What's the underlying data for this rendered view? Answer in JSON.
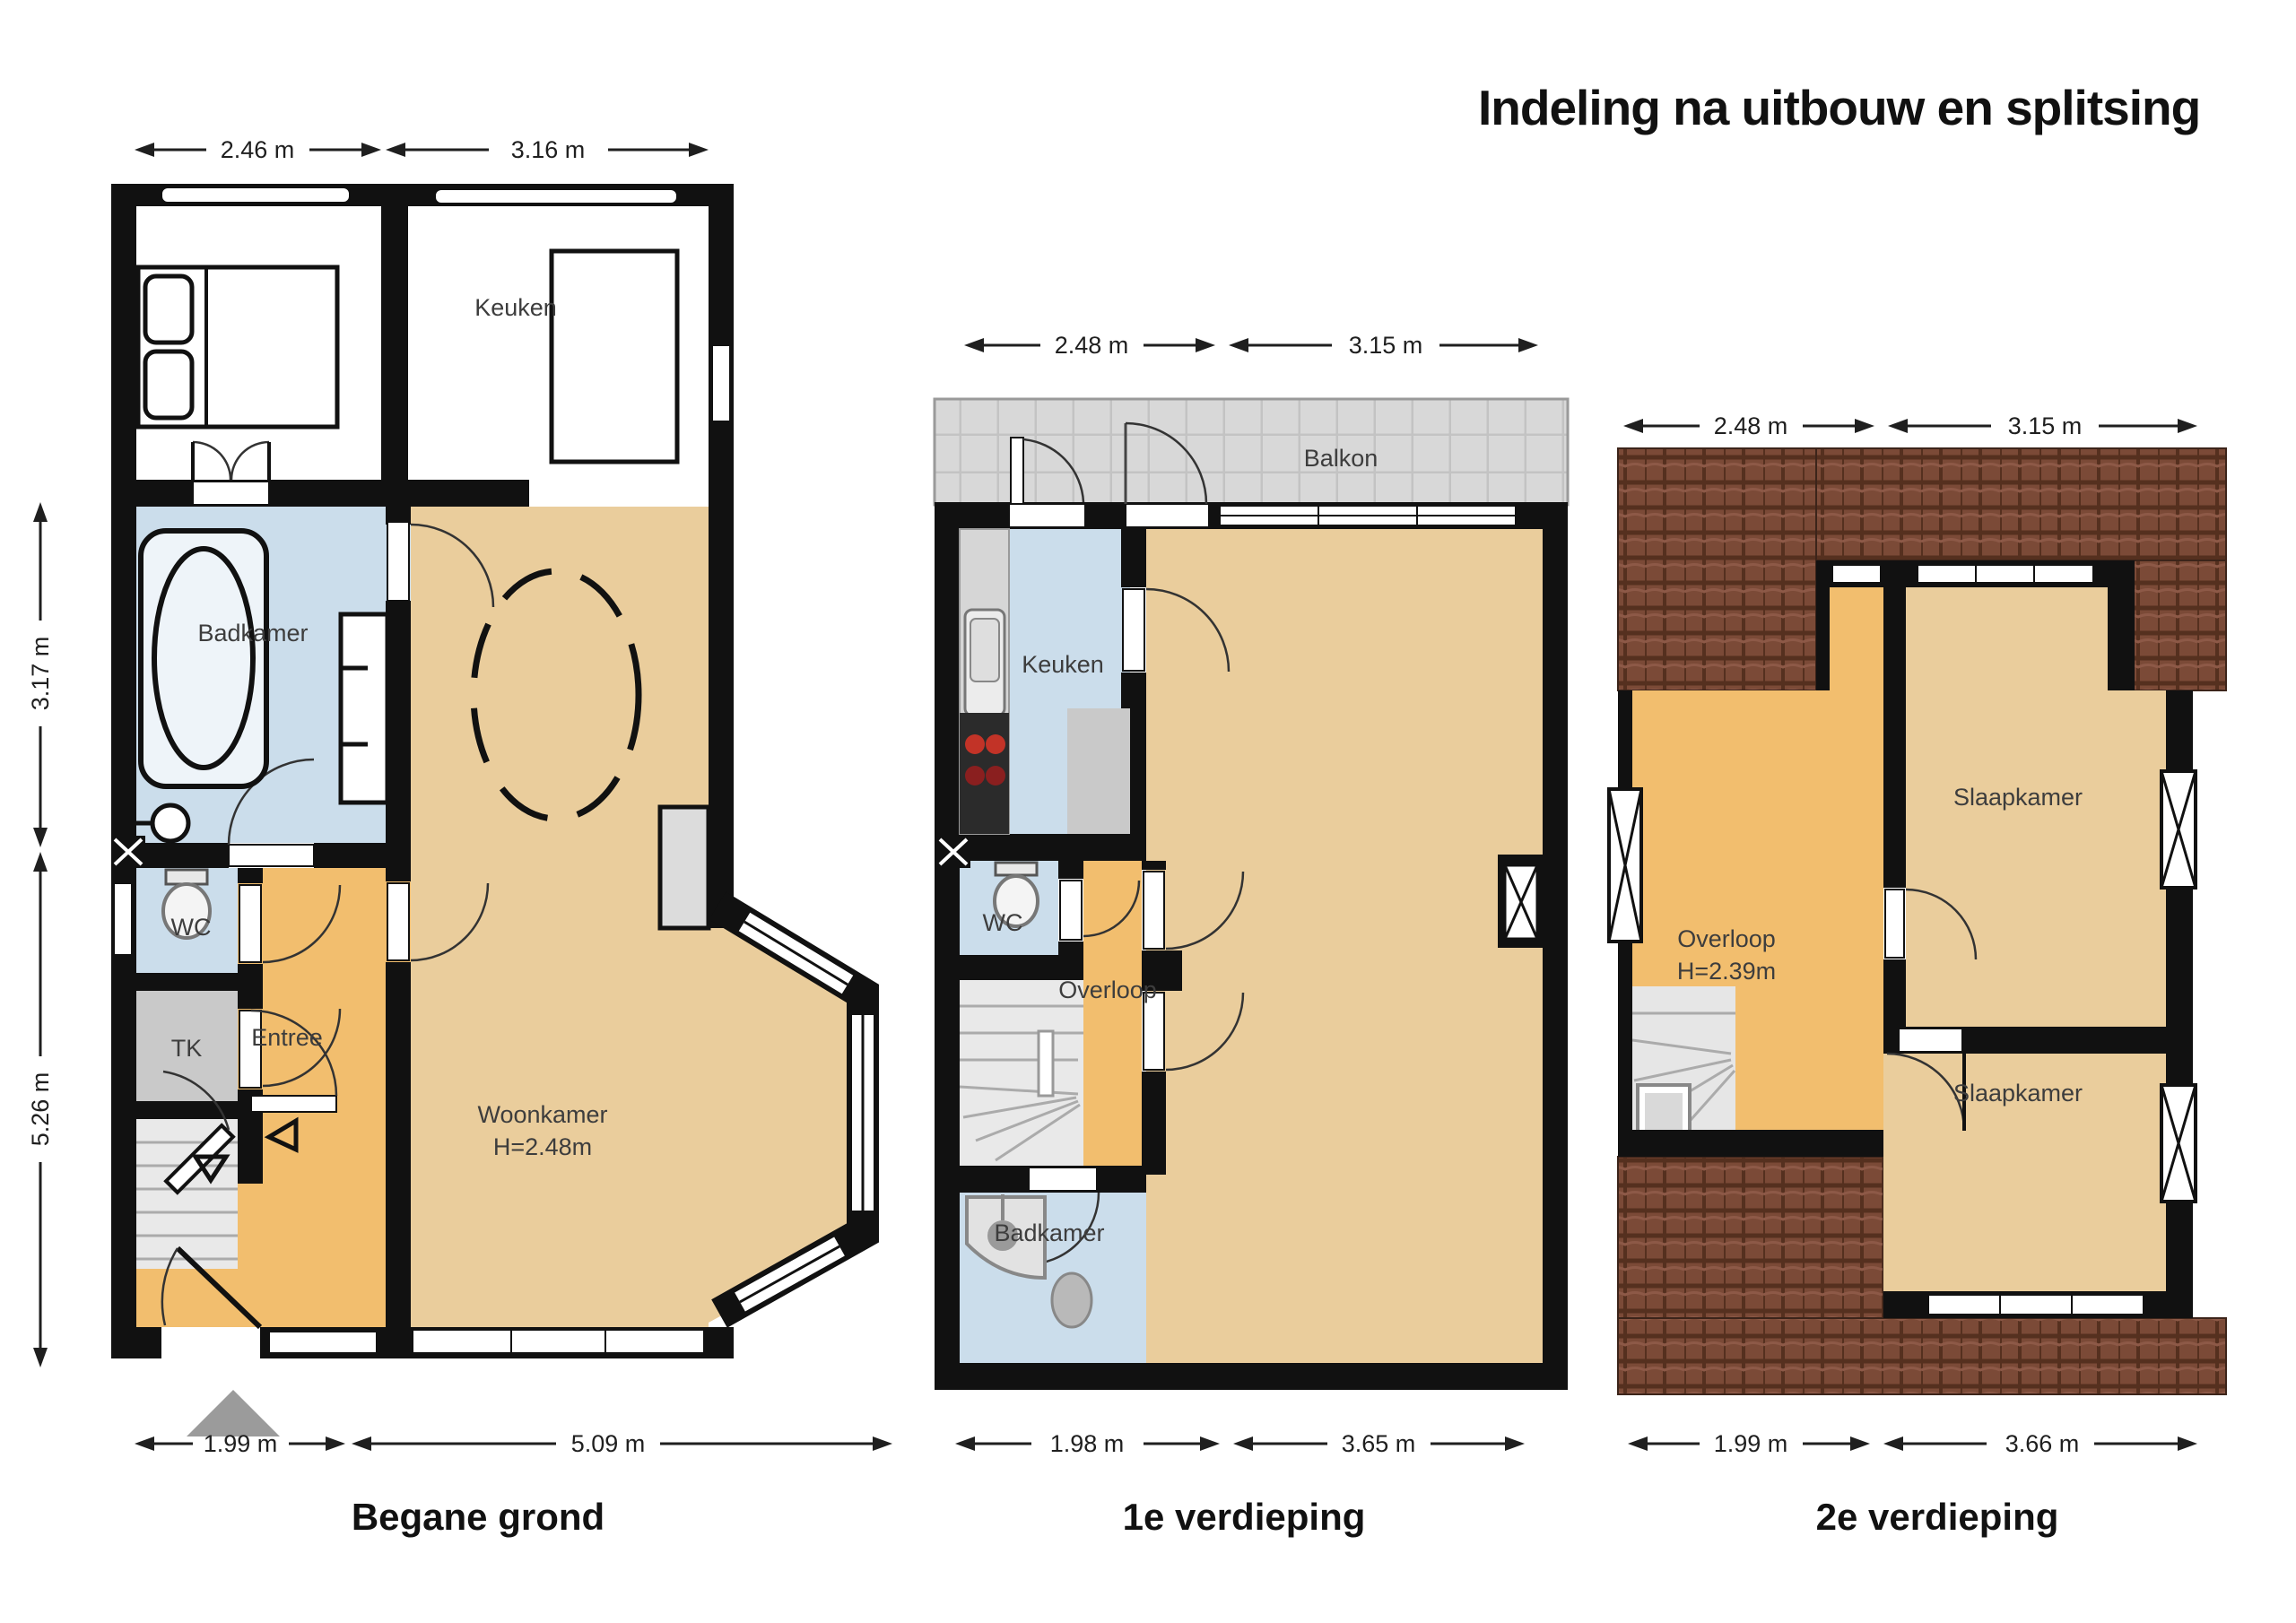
{
  "title": "Indeling na uitbouw en splitsing",
  "colors": {
    "wall": "#111111",
    "floor_tan": "#eacd9c",
    "floor_orange": "#f2be6e",
    "floor_blue": "#cbddeb",
    "floor_gray": "#c9c9c9",
    "stairs_gray": "#e9e9e9",
    "balkon_gray": "#d8d8d8",
    "roof_brown": "#7b4a37",
    "burner_red": "#c23327",
    "entry_arrow_gray": "#9b9b9b"
  },
  "floors": [
    {
      "name": "Begane grond",
      "dims": {
        "top": [
          "2.46 m",
          "3.16 m"
        ],
        "left": [
          "3.17 m",
          "5.26 m"
        ],
        "bottom": [
          "1.99 m",
          "5.09 m"
        ]
      },
      "rooms": {
        "keuken": "Keuken",
        "badkamer": "Badkamer",
        "wc": "WC",
        "tk": "TK",
        "entree": "Entree",
        "woonkamer": "Woonkamer",
        "woonkamer_height": "H=2.48m"
      }
    },
    {
      "name": "1e verdieping",
      "dims": {
        "top": [
          "2.48 m",
          "3.15 m"
        ],
        "bottom": [
          "1.98 m",
          "3.65 m"
        ]
      },
      "rooms": {
        "balkon": "Balkon",
        "keuken": "Keuken",
        "wc": "WC",
        "overloop": "Overloop",
        "badkamer": "Badkamer"
      }
    },
    {
      "name": "2e verdieping",
      "dims": {
        "top": [
          "2.48 m",
          "3.15 m"
        ],
        "bottom": [
          "1.99 m",
          "3.66 m"
        ]
      },
      "rooms": {
        "slaapkamer1": "Slaapkamer",
        "overloop": "Overloop",
        "overloop_height": "H=2.39m",
        "slaapkamer2": "Slaapkamer"
      }
    }
  ]
}
